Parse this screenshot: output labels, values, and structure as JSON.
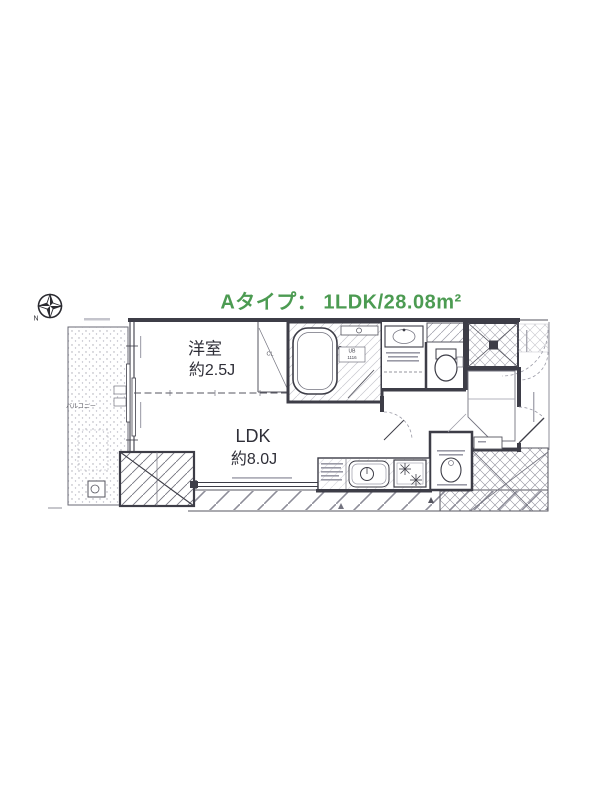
{
  "title": {
    "text": "Aタイプ： 1LDK/28.08m²",
    "color": "#4c9b52"
  },
  "compass": {
    "north_label": "N"
  },
  "floorplan": {
    "unit_type": "Aタイプ",
    "layout": "1LDK",
    "area": "28.08m²",
    "rooms": [
      {
        "name": "洋室",
        "size": "約2.5J"
      },
      {
        "name": "LDK",
        "size": "約8.0J"
      },
      {
        "name": "バルコニー",
        "size": ""
      },
      {
        "name": "CL",
        "size": ""
      },
      {
        "name": "UB",
        "size": "1116"
      }
    ]
  }
}
